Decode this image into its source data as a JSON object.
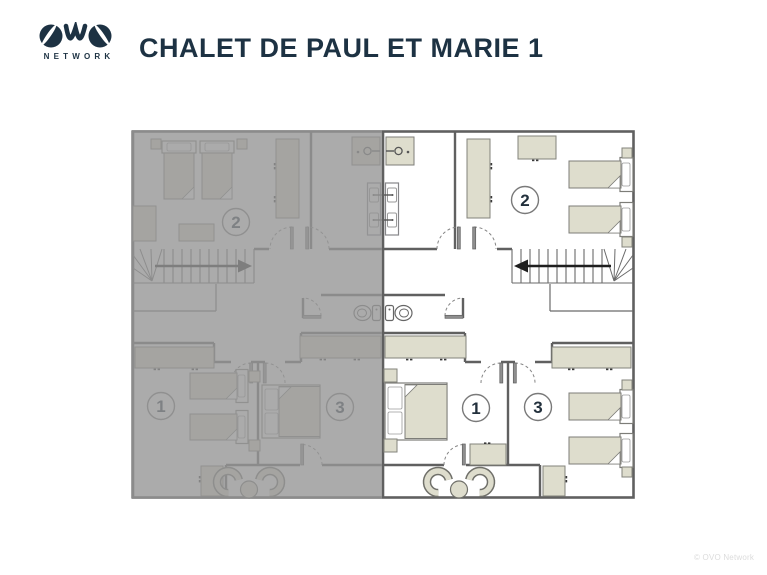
{
  "brand": {
    "name": "OVO",
    "network_label": "NETWORK"
  },
  "title": "CHALET DE PAUL ET MARIE 1",
  "copyright": "© OVO Network",
  "floor_plan": {
    "description": "floor-plan",
    "right_unit": {
      "highlighted": true,
      "labels": {
        "room1": "1",
        "room2": "2",
        "room3": "3"
      }
    },
    "left_unit": {
      "highlighted": false,
      "labels": {
        "room1": "1",
        "room2": "2",
        "room3": "3"
      }
    },
    "colors": {
      "navy": "#1d3243",
      "wall": "#606060",
      "furniture": "#deddcd",
      "overlay": "rgba(150,150,150,0.8)"
    }
  }
}
